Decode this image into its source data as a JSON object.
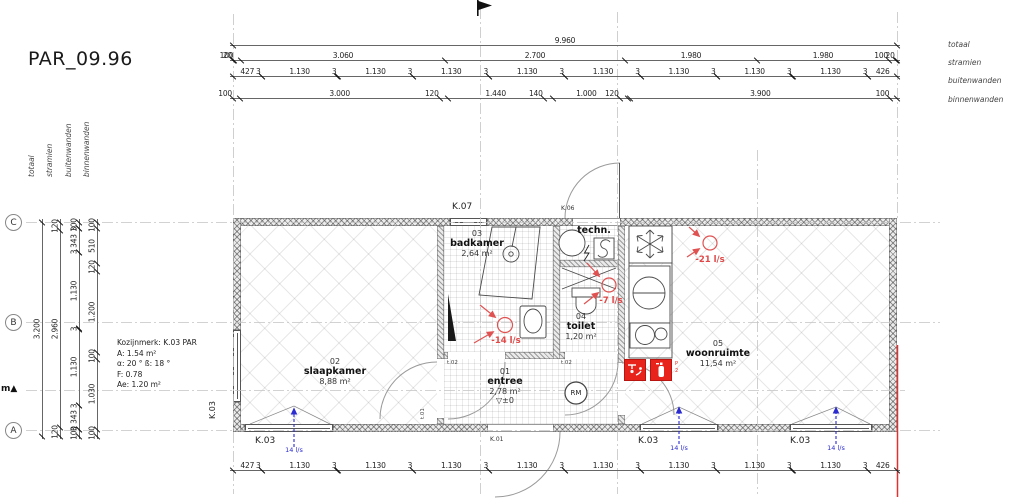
{
  "title": "PAR_09.96",
  "dim_labels": {
    "totaal": "totaal",
    "stramien": "stramien",
    "buitenwanden": "buitenwanden",
    "binnenwanden": "binnenwanden"
  },
  "dimensions": {
    "top_totaal": [
      {
        "t": "9.960",
        "mm": 9960
      }
    ],
    "top_stramien": [
      {
        "t": "20",
        "mm": 20
      },
      {
        "t": "100",
        "mm": 100
      },
      {
        "t": "3.060",
        "mm": 3060
      },
      {
        "t": "2.700",
        "mm": 2700
      },
      {
        "t": "1.980",
        "mm": 1980
      },
      {
        "t": "1.980",
        "mm": 1980
      },
      {
        "t": "100",
        "mm": 100
      },
      {
        "t": "20",
        "mm": 20
      }
    ],
    "top_buitenwanden": [
      {
        "t": "427",
        "mm": 427
      },
      {
        "t": "3",
        "mm": 3
      },
      {
        "t": "1.130",
        "mm": 1130
      },
      {
        "t": "3",
        "mm": 3
      },
      {
        "t": "1.130",
        "mm": 1130
      },
      {
        "t": "3",
        "mm": 3
      },
      {
        "t": "1.130",
        "mm": 1130
      },
      {
        "t": "3",
        "mm": 3
      },
      {
        "t": "1.130",
        "mm": 1130
      },
      {
        "t": "3",
        "mm": 3
      },
      {
        "t": "1.130",
        "mm": 1130
      },
      {
        "t": "3",
        "mm": 3
      },
      {
        "t": "1.130",
        "mm": 1130
      },
      {
        "t": "3",
        "mm": 3
      },
      {
        "t": "1.130",
        "mm": 1130
      },
      {
        "t": "3",
        "mm": 3
      },
      {
        "t": "1.130",
        "mm": 1130
      },
      {
        "t": "3",
        "mm": 3
      },
      {
        "t": "426",
        "mm": 426
      }
    ],
    "top_binnenwanden": [
      {
        "t": "100",
        "mm": 100
      },
      {
        "t": "3.000",
        "mm": 3000
      },
      {
        "t": "120",
        "mm": 120
      },
      {
        "t": "1.440",
        "mm": 1440
      },
      {
        "t": "140",
        "mm": 140
      },
      {
        "t": "1.000",
        "mm": 1000
      },
      {
        "t": "120",
        "mm": 120
      },
      {
        "t": "",
        "mm": 40
      },
      {
        "t": "3.900",
        "mm": 3900
      },
      {
        "t": "100",
        "mm": 100
      }
    ],
    "bottom_buitenwanden": [
      {
        "t": "427",
        "mm": 427
      },
      {
        "t": "3",
        "mm": 3
      },
      {
        "t": "1.130",
        "mm": 1130
      },
      {
        "t": "3",
        "mm": 3
      },
      {
        "t": "1.130",
        "mm": 1130
      },
      {
        "t": "3",
        "mm": 3
      },
      {
        "t": "1.130",
        "mm": 1130
      },
      {
        "t": "3",
        "mm": 3
      },
      {
        "t": "1.130",
        "mm": 1130
      },
      {
        "t": "3",
        "mm": 3
      },
      {
        "t": "1.130",
        "mm": 1130
      },
      {
        "t": "3",
        "mm": 3
      },
      {
        "t": "1.130",
        "mm": 1130
      },
      {
        "t": "3",
        "mm": 3
      },
      {
        "t": "1.130",
        "mm": 1130
      },
      {
        "t": "3",
        "mm": 3
      },
      {
        "t": "1.130",
        "mm": 1130
      },
      {
        "t": "3",
        "mm": 3
      },
      {
        "t": "426",
        "mm": 426
      }
    ],
    "left_totaal": [
      {
        "t": "3.200",
        "mm": 3200
      }
    ],
    "left_stramien": [
      {
        "t": "120",
        "mm": 120
      },
      {
        "t": "2.960",
        "mm": 2960
      },
      {
        "t": "120",
        "mm": 120
      }
    ],
    "left_buitenwanden": [
      {
        "t": "100",
        "mm": 100
      },
      {
        "t": "3",
        "mm": 3
      },
      {
        "t": "343",
        "mm": 343
      },
      {
        "t": "3",
        "mm": 3
      },
      {
        "t": "1.130",
        "mm": 1130
      },
      {
        "t": "3",
        "mm": 3
      },
      {
        "t": "1.130",
        "mm": 1130
      },
      {
        "t": "3",
        "mm": 3
      },
      {
        "t": "343",
        "mm": 343
      },
      {
        "t": "3",
        "mm": 3
      },
      {
        "t": "100",
        "mm": 100
      }
    ],
    "left_binnenwanden": [
      {
        "t": "100",
        "mm": 100
      },
      {
        "t": "510",
        "mm": 510
      },
      {
        "t": "120",
        "mm": 120
      },
      {
        "t": "1.200",
        "mm": 1200
      },
      {
        "t": "100",
        "mm": 100
      },
      {
        "t": "1.030",
        "mm": 1030
      },
      {
        "t": "100",
        "mm": 100
      }
    ]
  },
  "grid_bubbles": [
    "C",
    "B",
    "A"
  ],
  "side_marker": {
    "text": "m",
    "arrow": "▲"
  },
  "kozijn": {
    "lines": [
      "Kozijnmerk: K.03 PAR",
      "A: 1.54 m²",
      "α: 20 °    ß: 18 °",
      "F: 0.78",
      "Ae: 1.20 m²"
    ]
  },
  "rooms": {
    "badkamer": {
      "number": "03",
      "name": "badkamer",
      "area": "2,64 m²"
    },
    "techn": {
      "name": "techn."
    },
    "toilet": {
      "number": "04",
      "name": "toilet",
      "area": "1,20 m²"
    },
    "slaapkamer": {
      "number": "02",
      "name": "slaapkamer",
      "area": "8,88 m²"
    },
    "entree": {
      "number": "01",
      "name": "entree",
      "area": "2,78 m²",
      "level_symbol": "▽",
      "level": "±0"
    },
    "woonruimte": {
      "number": "05",
      "name": "woonruimte",
      "area": "11,54 m²"
    }
  },
  "openings": {
    "k07": "K.07",
    "k06": "K.06",
    "k01": "K.01",
    "k03": "K.03"
  },
  "door_tags": {
    "badkamer": "t.02",
    "toilet": "t.02",
    "slaapkamer": "t.01"
  },
  "vent": {
    "supply": "14 l/s",
    "extract": [
      "-14 l/s",
      "-7 l/s",
      "-21 l/s"
    ]
  },
  "smoke_detector": "RM",
  "fire": {
    "p": "P",
    "n": "2"
  },
  "colors": {
    "safety_red": "#e8231c",
    "annotation_red": "#e05252",
    "supply_blue": "#2b2bd0",
    "line": "#555555"
  }
}
